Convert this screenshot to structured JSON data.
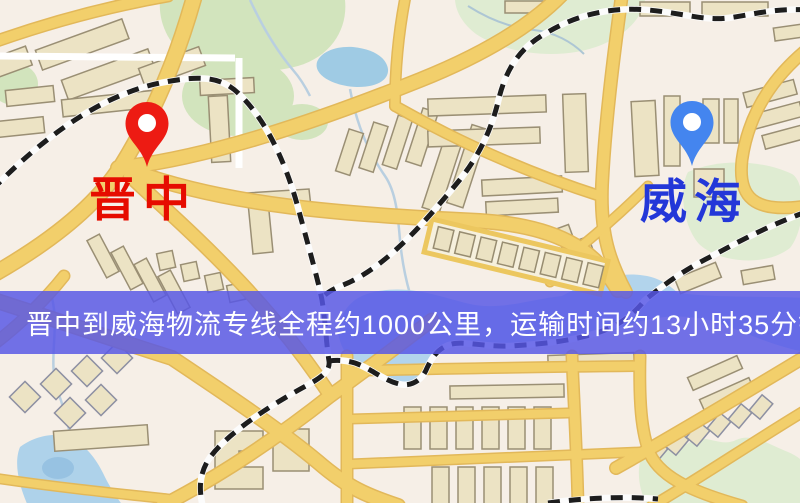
{
  "window": {
    "width": 800,
    "height": 503
  },
  "banner": {
    "text": "晋中到威海物流专线全程约1000公里，运输时间约13小时35分钟.",
    "background_color": "#5757e6",
    "text_color": "#ffffff"
  },
  "markers": {
    "origin": {
      "label": "晋中",
      "pin_color": "#ed1b13",
      "label_color": "#e60c00",
      "icon": "map-pin"
    },
    "destination": {
      "label": "威海",
      "pin_color": "#4485ef",
      "label_color": "#2337d8",
      "icon": "map-pin"
    }
  },
  "map": {
    "background_color": "#f6efe7",
    "road_color": "#f2cf6b",
    "road_casing_color": "#e2b85a",
    "railway_color": "#1d1d1d",
    "water_color": "#aed2ea",
    "park_color": "#d2e4bd",
    "building_color": "#ece3c4"
  }
}
